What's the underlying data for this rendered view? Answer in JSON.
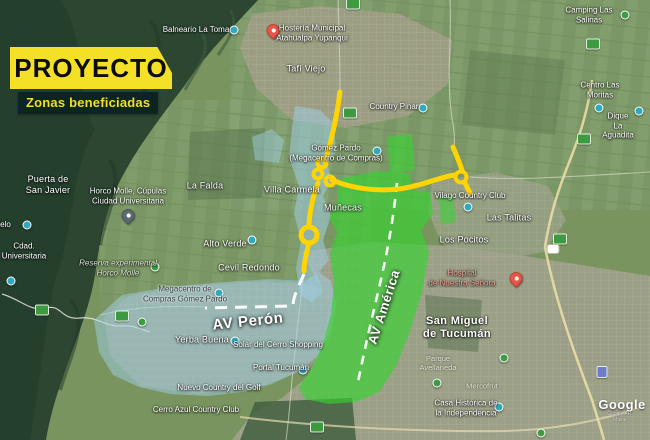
{
  "title": {
    "heading": "PROYECTO",
    "subheading": "Zonas beneficiadas"
  },
  "colors": {
    "accent_yellow": "#f4e127",
    "panel_dark": "#0c2422",
    "zone_blue": "#9fd0e8",
    "zone_green": "#35d32f",
    "route_yellow": "#ffd400"
  },
  "icons": {
    "poi_dot": "teal-circle",
    "tree_poi": "green-circle",
    "place_marker": "red-teardrop",
    "hospital_marker": "red-teardrop",
    "route_shield": "green-rounded-rect",
    "route_badge": "white-rounded-rect",
    "mall_shield": "purple-rounded-rect",
    "roundabout": "yellow-ring"
  },
  "map": {
    "labels": {
      "balneario_la_toma": "Balneario La Toma",
      "hosteria": "Hostería Municipal\nAtahualpa Yupanqui",
      "tafi_viejo": "Tafí Viejo",
      "camping_las_salinas": "Camping Las Salinas",
      "centro_las_moritas": "Centro Las Moritas",
      "dique_la_aguadita": "Dique La Aguadita",
      "country_pinar": "Country Pinar",
      "puerta_san_javier": "Puerta de\nSan Javier",
      "horco_molle_cupulas": "Horco Molle, Cúpulas\nCiudad Universitaria",
      "el_cielo": "El Cielo",
      "cdad_universitaria": "Cdad.\nUniversitaria",
      "la_falda": "La Falda",
      "villa_carmela": "Villa Carmela",
      "alto_verde": "Alto Verde",
      "cevil_redondo": "Cevil Redondo",
      "munecas": "Muñecas",
      "gomez_pardo": "Gómez Pardo\n(Megacentro de Compras)",
      "vilago_country_club": "Vilago Country Club",
      "las_talitas": "Las Talitas",
      "los_pocitos": "Los Pocitos",
      "reserva_horco_molle": "Reserva experimental\nHorco Molle",
      "megacentro_compras": "Megacentro de\nCompras Gómez Pardo",
      "yerba_buena": "Yerba Buena",
      "solar_del_cerro": "Solar del Cerro Shopping",
      "portal_tucuman": "Portal Tucumán",
      "nuevo_country_golf": "Nuevo Country del Golf",
      "cerro_azul_cc": "Cerro Azul Country Club",
      "san_miguel": "San Miguel\nde Tucumán",
      "hospital": "Hospital\nde Nuestra Señora",
      "parque_avellaneda": "Parque\nAvellaneda",
      "casa_historica": "Casa Histórica de\nla Independencia",
      "mercofrut": "Mercofrut"
    },
    "avenues": {
      "peron": "AV Perón",
      "america": "AV América"
    },
    "watermark": {
      "logo": "Google",
      "attribution": "Google AR, Maxar"
    }
  }
}
